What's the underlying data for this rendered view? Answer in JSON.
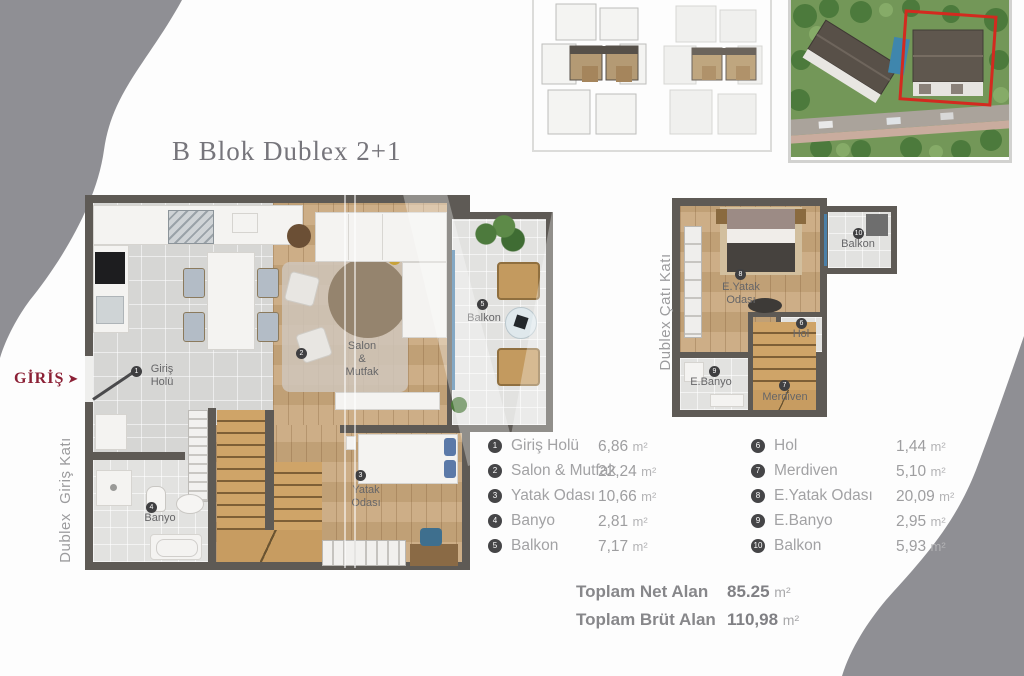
{
  "title": "B Blok Dublex 2+1",
  "entrance": {
    "label": "GİRİŞ",
    "arrow": "➤"
  },
  "ground_plan": {
    "side_label": "Dublex  Giriş Katı",
    "labels": {
      "giris_l1": "Giriş",
      "giris_l2": "Holü",
      "salon_l1": "Salon",
      "salon_l2": "&",
      "salon_l3": "Mutfak",
      "balkon": "Balkon",
      "banyo": "Banyo",
      "yatak_l1": "Yatak",
      "yatak_l2": "Odası"
    }
  },
  "roof_plan": {
    "side_label": "Dublex Çatı Katı",
    "labels": {
      "eyatak_l1": "E.Yatak",
      "eyatak_l2": "Odası",
      "balkon": "Balkon",
      "hol": "Hol",
      "merdiven": "Merdiven",
      "ebanyo": "E.Banyo"
    }
  },
  "legend": {
    "left": [
      {
        "num": "1",
        "label": "Giriş Holü",
        "area": "6,86",
        "unit": "m²"
      },
      {
        "num": "2",
        "label": "Salon & Mutfak",
        "area": "22,24",
        "unit": "m²"
      },
      {
        "num": "3",
        "label": "Yatak Odası",
        "area": "10,66",
        "unit": "m²"
      },
      {
        "num": "4",
        "label": "Banyo",
        "area": "2,81",
        "unit": "m²"
      },
      {
        "num": "5",
        "label": "Balkon",
        "area": "7,17",
        "unit": "m²"
      }
    ],
    "right": [
      {
        "num": "6",
        "label": "Hol",
        "area": "1,44",
        "unit": "m²"
      },
      {
        "num": "7",
        "label": "Merdiven",
        "area": "5,10",
        "unit": "m²"
      },
      {
        "num": "8",
        "label": "E.Yatak Odası",
        "area": "20,09",
        "unit": "m²"
      },
      {
        "num": "9",
        "label": "E.Banyo",
        "area": "2,95",
        "unit": "m²"
      },
      {
        "num": "10",
        "label": "Balkon",
        "area": "5,93",
        "unit": "m²"
      }
    ]
  },
  "totals": [
    {
      "label": "Toplam Net Alan",
      "value": "85.25",
      "unit": "m²"
    },
    {
      "label": "Toplam Brüt Alan",
      "value": "110,98",
      "unit": "m²"
    }
  ],
  "colors": {
    "accent_red": "#8c2136",
    "wall": "#5e5a55",
    "wood": "#c9a87e",
    "marker": "#3f3f41",
    "highlight_outline": "#d32a1f"
  }
}
